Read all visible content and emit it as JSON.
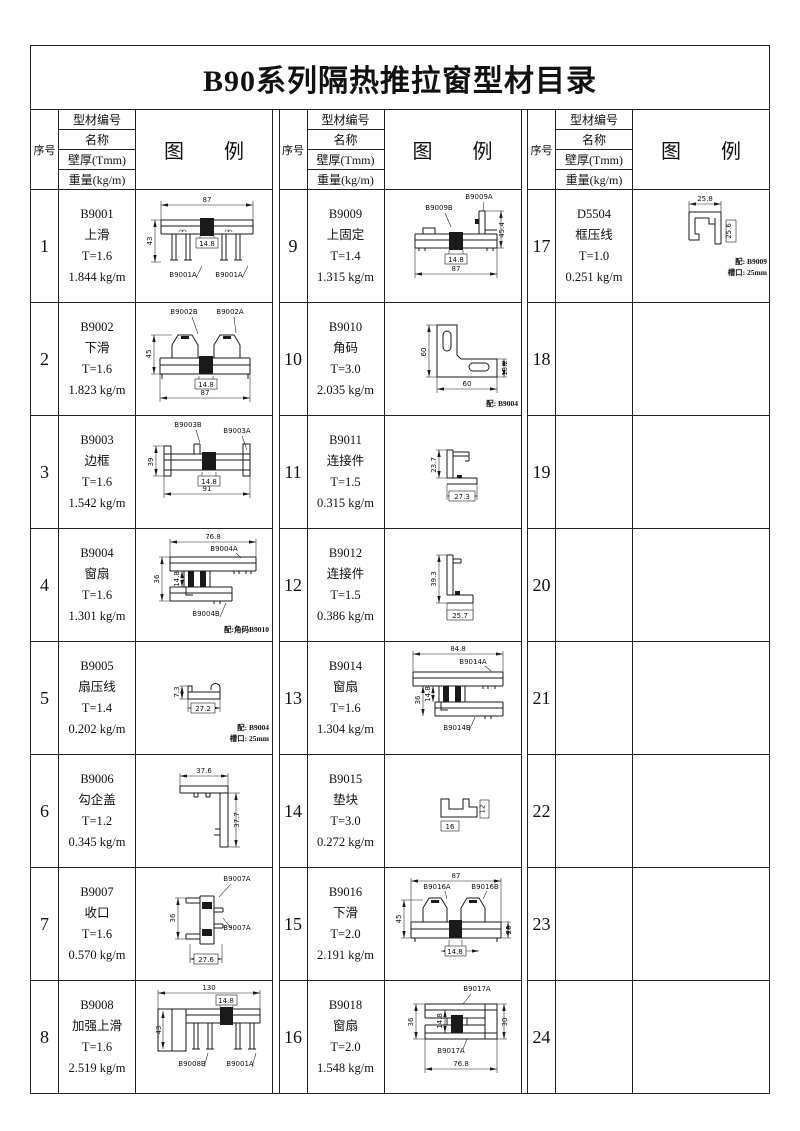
{
  "title": "B90系列隔热推拉窗型材目录",
  "header": {
    "no": "序号",
    "code": "型材编号",
    "name": "名称",
    "thickness": "壁厚(Tmm)",
    "weight": "重量(kg/m)",
    "diagram": "图　　例"
  },
  "rows": [
    {
      "no": "1",
      "code": "B9001",
      "name": "上滑",
      "thickness": "T=1.6",
      "weight": "1.844 kg/m",
      "diagram": {
        "w": "87",
        "h": "43",
        "c": "14.8",
        "l1": "B9001A",
        "l2": "B9001A"
      }
    },
    {
      "no": "2",
      "code": "B9002",
      "name": "下滑",
      "thickness": "T=1.6",
      "weight": "1.823 kg/m",
      "diagram": {
        "w": "87",
        "h": "45",
        "c": "14.8",
        "l1": "B9002B",
        "l2": "B9002A"
      }
    },
    {
      "no": "3",
      "code": "B9003",
      "name": "边框",
      "thickness": "T=1.6",
      "weight": "1.542 kg/m",
      "diagram": {
        "w": "91",
        "h": "39",
        "c": "14.8",
        "l1": "B9003B",
        "l2": "B9003A"
      }
    },
    {
      "no": "4",
      "code": "B9004",
      "name": "窗扇",
      "thickness": "T=1.6",
      "weight": "1.301 kg/m",
      "diagram": {
        "w": "76.8",
        "h": "36",
        "c": "14.8",
        "l1": "B9004A",
        "l2": "B9004B",
        "n1": "配:角码B9010"
      }
    },
    {
      "no": "5",
      "code": "B9005",
      "name": "扇压线",
      "thickness": "T=1.4",
      "weight": "0.202 kg/m",
      "diagram": {
        "w": "27.2",
        "h": "7.3",
        "n1": "配: B9004",
        "n2": "槽口: 25mm"
      }
    },
    {
      "no": "6",
      "code": "B9006",
      "name": "勾企盖",
      "thickness": "T=1.2",
      "weight": "0.345 kg/m",
      "diagram": {
        "w": "37.6",
        "h": "37.7"
      }
    },
    {
      "no": "7",
      "code": "B9007",
      "name": "收口",
      "thickness": "T=1.6",
      "weight": "0.570 kg/m",
      "diagram": {
        "w": "27.6",
        "h": "36",
        "l1": "B9007A",
        "l2": "B9007A"
      }
    },
    {
      "no": "8",
      "code": "B9008",
      "name": "加强上滑",
      "thickness": "T=1.6",
      "weight": "2.519 kg/m",
      "diagram": {
        "w": "130",
        "h": "43",
        "c": "14.8",
        "l1": "B9008B",
        "l2": "B9001A"
      }
    },
    {
      "no": "9",
      "code": "B9009",
      "name": "上固定",
      "thickness": "T=1.4",
      "weight": "1.315 kg/m",
      "diagram": {
        "w": "87",
        "h": "45.4",
        "c": "14.8",
        "l1": "B9009A",
        "l2": "B9009B"
      }
    },
    {
      "no": "10",
      "code": "B9010",
      "name": "角码",
      "thickness": "T=3.0",
      "weight": "2.035 kg/m",
      "diagram": {
        "w": "60",
        "h": "60",
        "d2": "13.2",
        "n1": "配: B9004"
      }
    },
    {
      "no": "11",
      "code": "B9011",
      "name": "连接件",
      "thickness": "T=1.5",
      "weight": "0.315 kg/m",
      "diagram": {
        "w": "27.3",
        "h": "23.7"
      }
    },
    {
      "no": "12",
      "code": "B9012",
      "name": "连接件",
      "thickness": "T=1.5",
      "weight": "0.386 kg/m",
      "diagram": {
        "w": "25.7",
        "h": "39.3"
      }
    },
    {
      "no": "13",
      "code": "B9014",
      "name": "窗扇",
      "thickness": "T=1.6",
      "weight": "1.304 kg/m",
      "diagram": {
        "w": "84.8",
        "h": "36",
        "c": "14.8",
        "l1": "B9014A",
        "l2": "B9014B"
      }
    },
    {
      "no": "14",
      "code": "B9015",
      "name": "垫块",
      "thickness": "T=3.0",
      "weight": "0.272 kg/m",
      "diagram": {
        "w": "16",
        "d2": "12"
      }
    },
    {
      "no": "15",
      "code": "B9016",
      "name": "下滑",
      "thickness": "T=2.0",
      "weight": "2.191 kg/m",
      "diagram": {
        "w": "87",
        "h": "45",
        "c": "14.8",
        "d2": "20",
        "l1": "B9016A",
        "l2": "B9016B"
      }
    },
    {
      "no": "16",
      "code": "B9018",
      "name": "窗扇",
      "thickness": "T=2.0",
      "weight": "1.548 kg/m",
      "diagram": {
        "w": "76.8",
        "h": "36",
        "c": "14.8",
        "d2": "30",
        "l1": "B9017A",
        "l2": "B9017A"
      }
    },
    {
      "no": "17",
      "code": "D5504",
      "name": "框压线",
      "thickness": "T=1.0",
      "weight": "0.251 kg/m",
      "diagram": {
        "w": "25.8",
        "h": "25.6",
        "n1": "配: B9009",
        "n2": "槽口: 25mm"
      }
    },
    {
      "no": "18"
    },
    {
      "no": "19"
    },
    {
      "no": "20"
    },
    {
      "no": "21"
    },
    {
      "no": "22"
    },
    {
      "no": "23"
    },
    {
      "no": "24"
    }
  ]
}
